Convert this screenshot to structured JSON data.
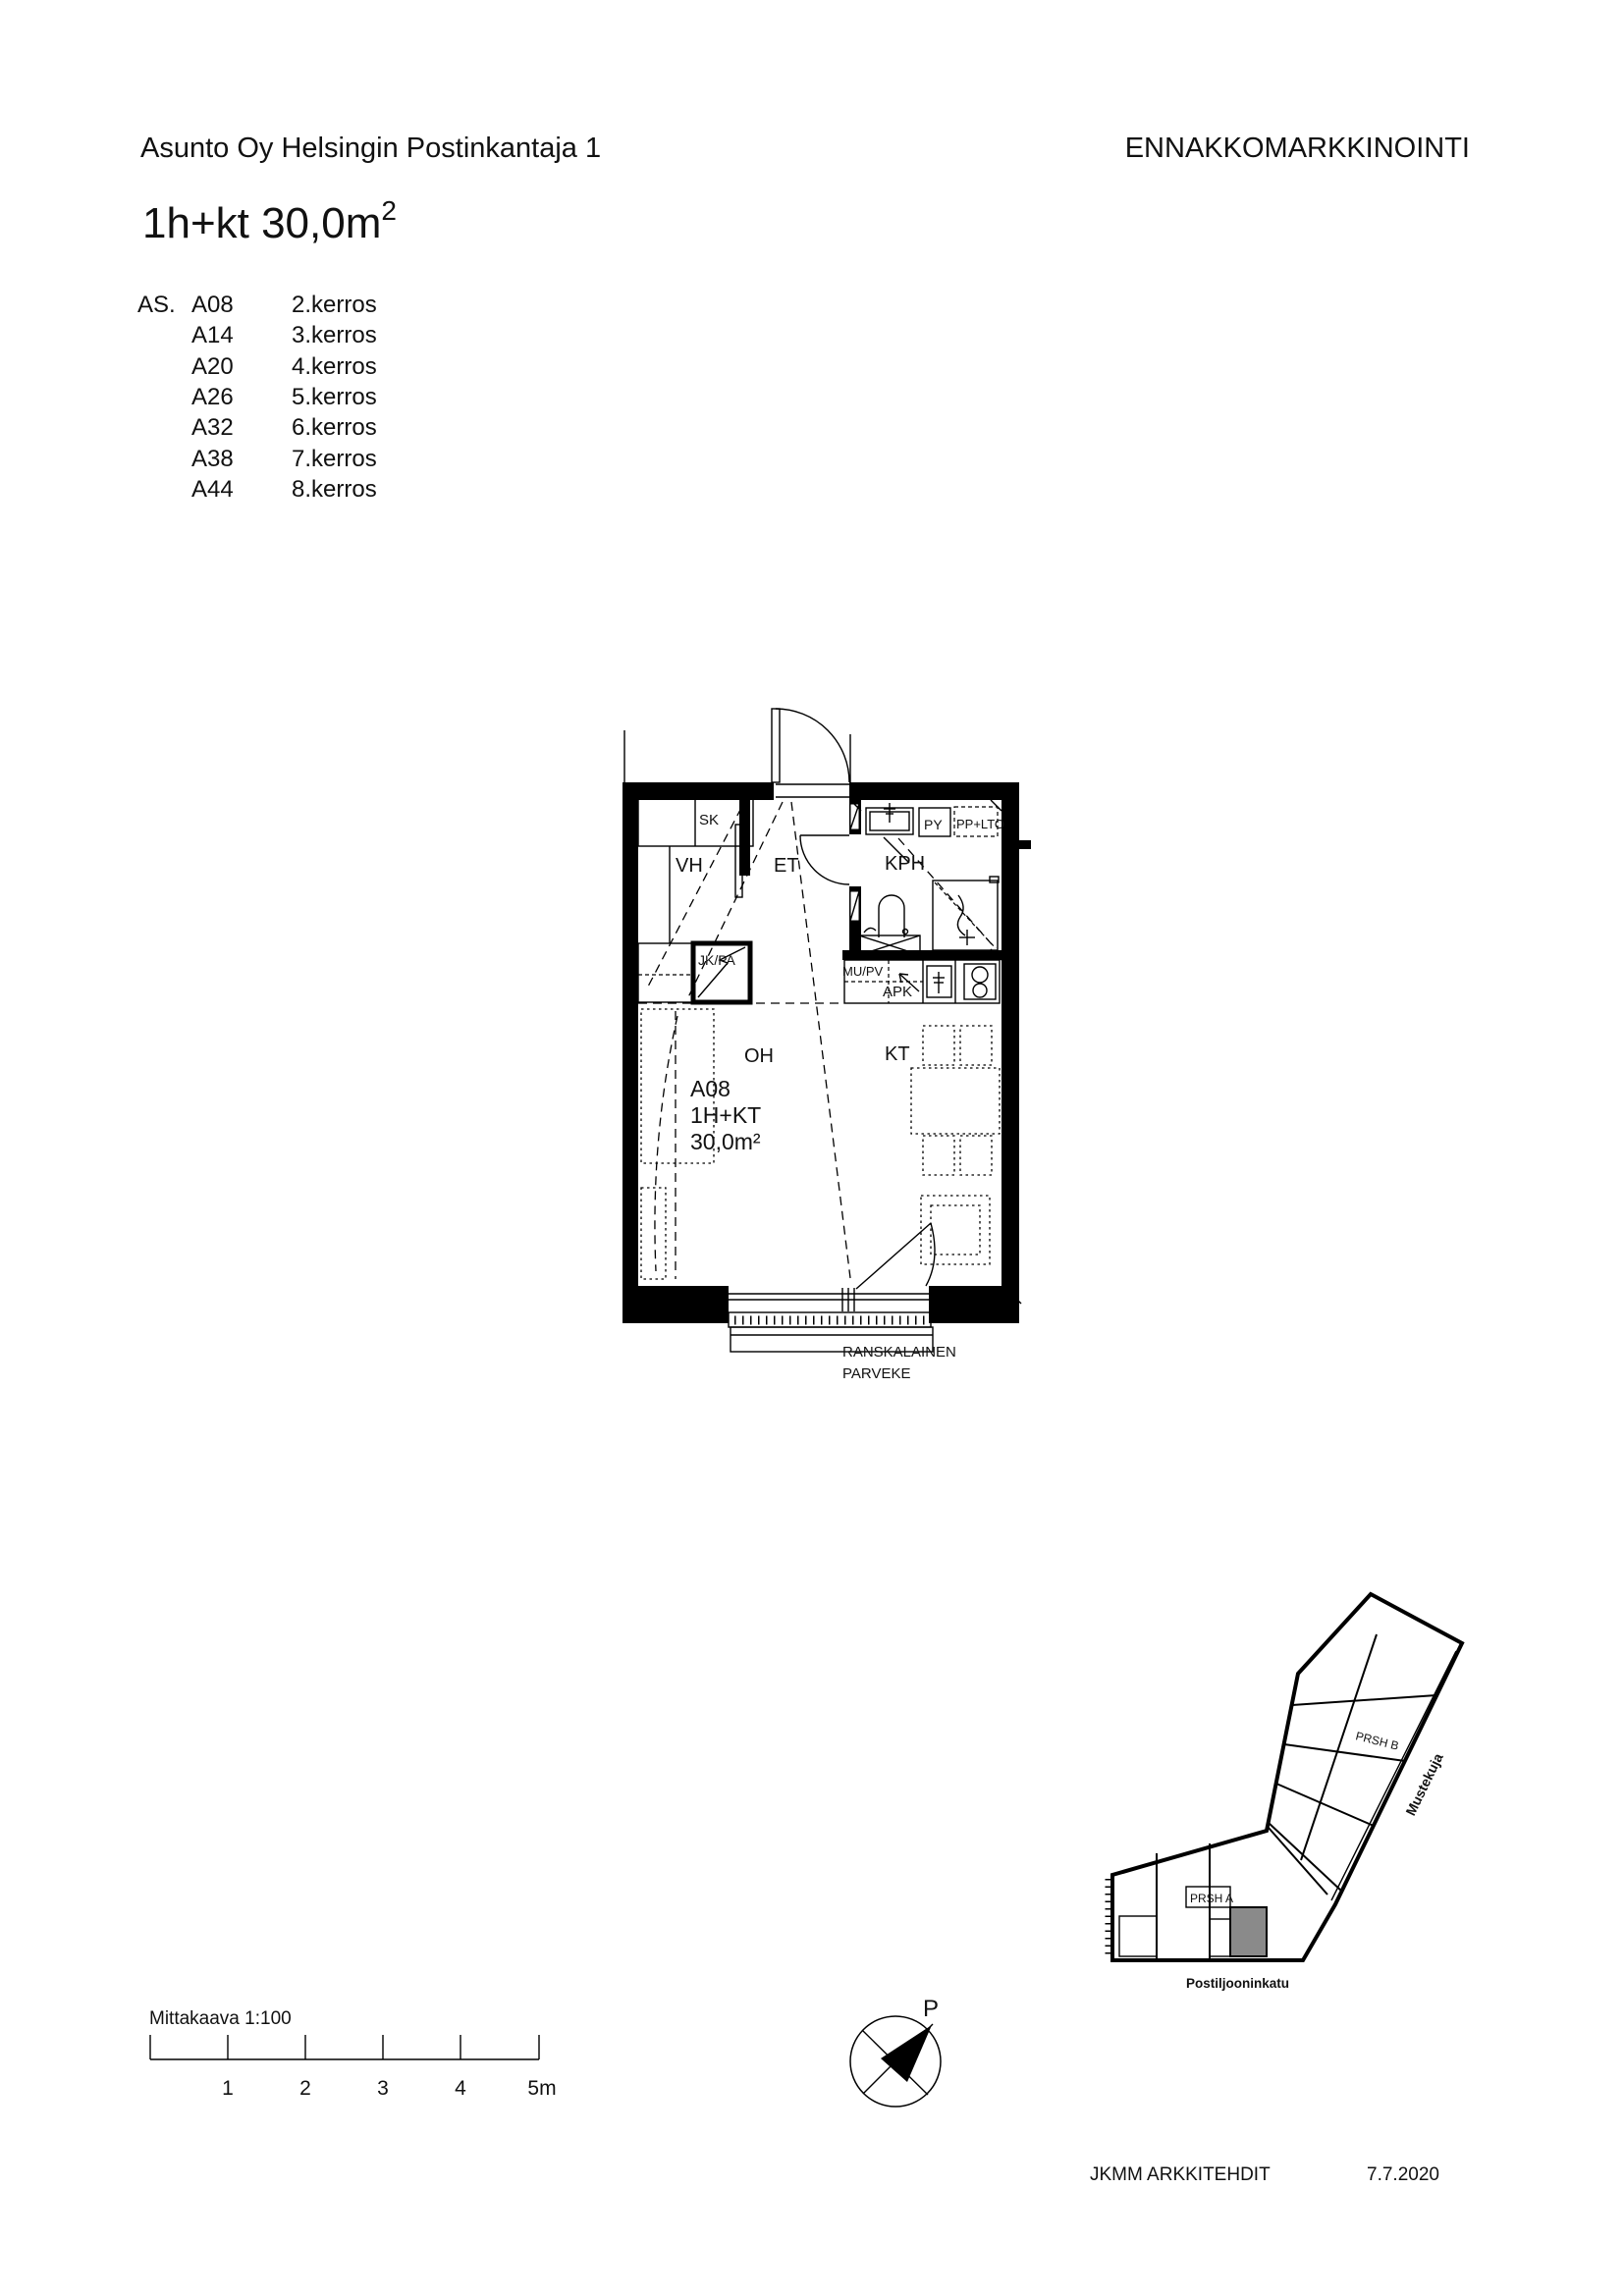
{
  "header": {
    "project": "Asunto Oy Helsingin Postinkantaja 1",
    "status": "ENNAKKOMARKKINOINTI"
  },
  "title": {
    "main": "1h+kt 30,0m",
    "sup": "2"
  },
  "apartment_list": {
    "label": "AS.",
    "rows": [
      {
        "code": "A08",
        "floor": "2.kerros"
      },
      {
        "code": "A14",
        "floor": "3.kerros"
      },
      {
        "code": "A20",
        "floor": "4.kerros"
      },
      {
        "code": "A26",
        "floor": "5.kerros"
      },
      {
        "code": "A32",
        "floor": "6.kerros"
      },
      {
        "code": "A38",
        "floor": "7.kerros"
      },
      {
        "code": "A44",
        "floor": "8.kerros"
      }
    ]
  },
  "floor_plan": {
    "rooms": {
      "sk": "SK",
      "vh": "VH",
      "et": "ET",
      "kph": "KPH",
      "oh": "OH",
      "kt": "KT"
    },
    "fixtures": {
      "py": "PY",
      "pp_lto": "PP+LTO",
      "jk_pa": "JK/PA",
      "mu_pv": "MU/PV",
      "apk": "APK"
    },
    "unit": {
      "code": "A08",
      "type": "1H+KT",
      "area": "30,0m²"
    },
    "balcony": {
      "line1": "RANSKALAINEN",
      "line2": "PARVEKE"
    }
  },
  "site_plan": {
    "building_a": "PRSH A",
    "building_b": "PRSH B",
    "street_east": "Mustekuja",
    "street_south": "Postiljooninkatu"
  },
  "scale_bar": {
    "label": "Mittakaava 1:100",
    "ticks": [
      "1",
      "2",
      "3",
      "4",
      "5m"
    ]
  },
  "compass": {
    "north_label": "P"
  },
  "footer": {
    "architect": "JKMM ARKKITEHDIT",
    "date": "7.7.2020"
  },
  "colors": {
    "ink": "#111111",
    "wall": "#000000",
    "highlight_unit": "#8a8a8a"
  }
}
